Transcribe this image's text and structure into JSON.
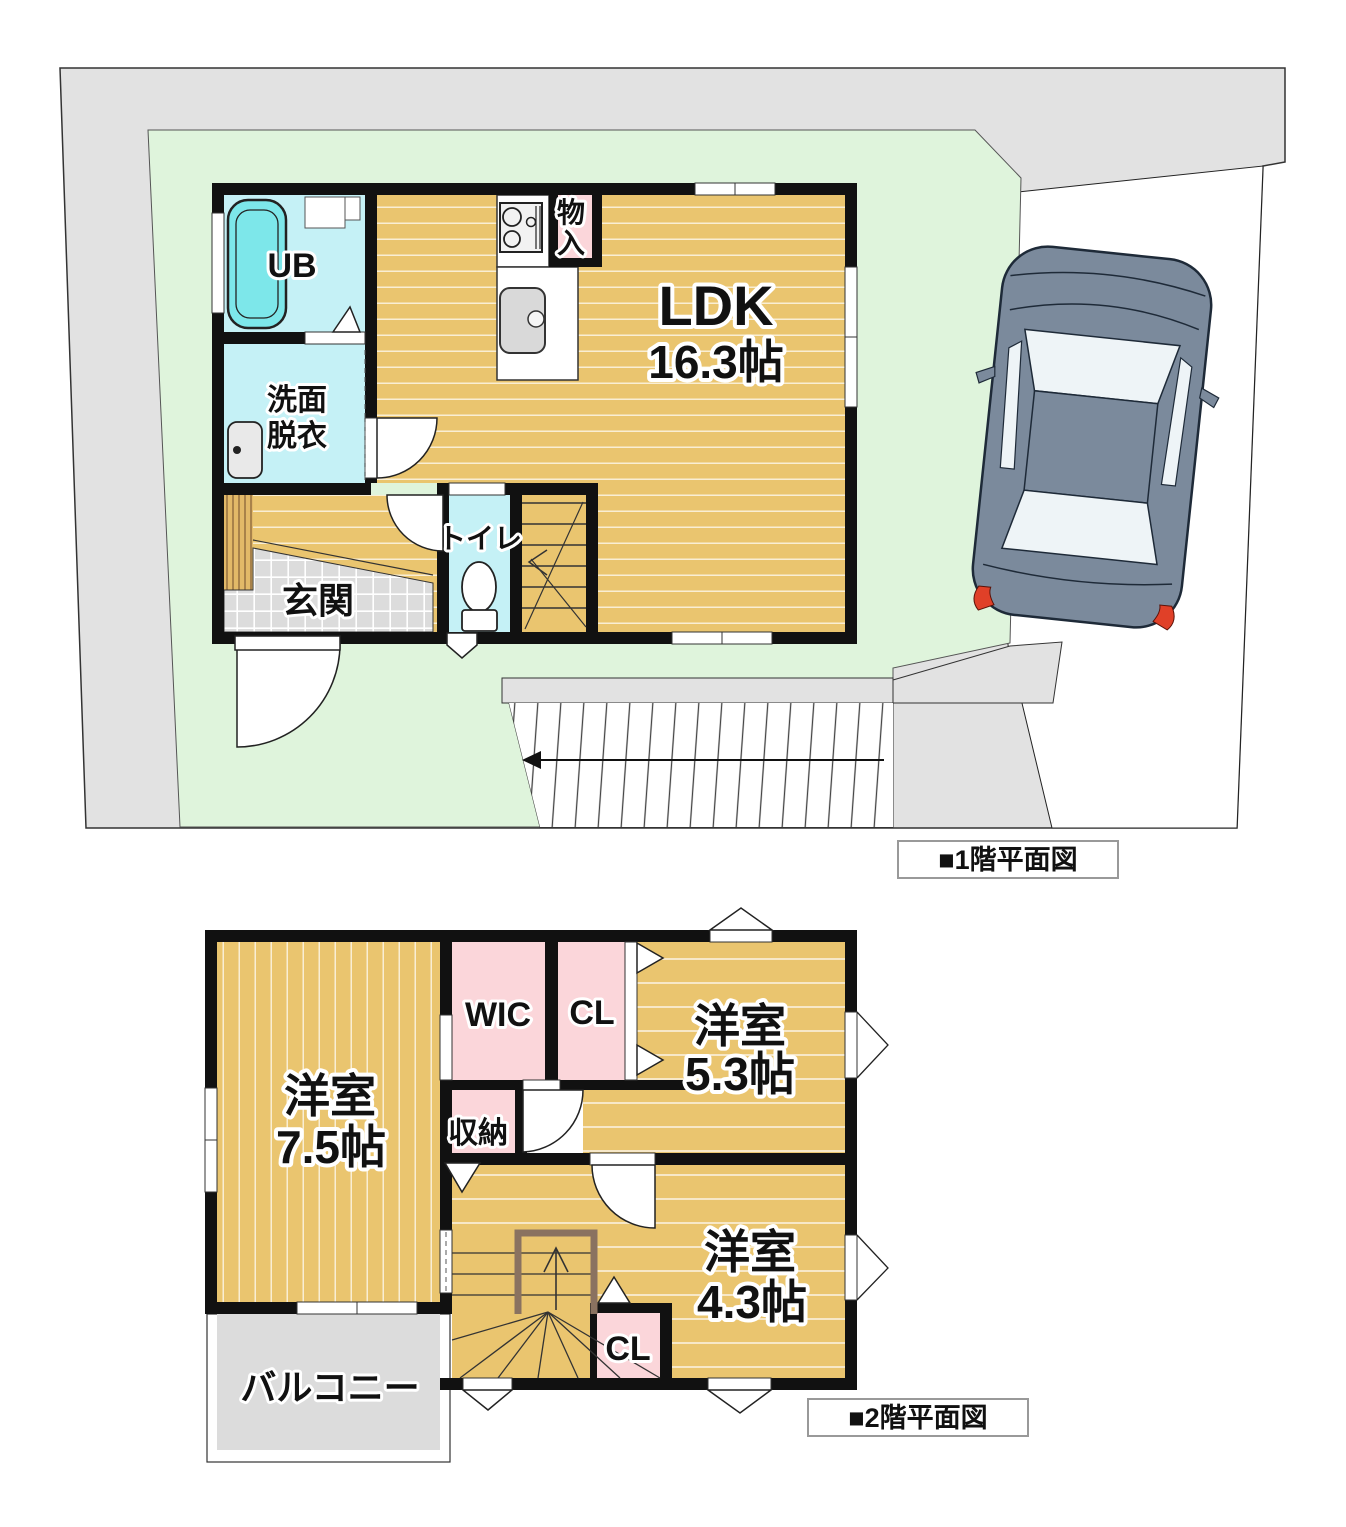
{
  "floor1": {
    "caption": "■1階平面図",
    "ldk_name": "LDK",
    "ldk_size": "16.3帖",
    "ub_label": "UB",
    "wash_line1": "洗面",
    "wash_line2": "脱衣",
    "toilet_label": "トイレ",
    "entrance_label": "玄関",
    "storage_label": "物入"
  },
  "floor2": {
    "caption": "■2階平面図",
    "room75_name": "洋室",
    "room75_size": "7.5帖",
    "room53_name": "洋室",
    "room53_size": "5.3帖",
    "room43_name": "洋室",
    "room43_size": "4.3帖",
    "wic_label": "WIC",
    "cl_upper_label": "CL",
    "cl_lower_label": "CL",
    "storage_label": "収納",
    "balcony_label": "バルコニー"
  },
  "colors": {
    "wall": "#111111",
    "floor_wood": "#eac56f",
    "room_pink": "#fbd6da",
    "room_cyan": "#c5f1f6",
    "bathtub": "#7de7ea",
    "lawn_green": "#dff4dc",
    "road_gray": "#e2e2e2",
    "tile_gray": "#dcdcdc",
    "balcony_gray": "#dcdcdc",
    "stair_rail_brown": "#8a7260",
    "car_body": "#7b8a9c",
    "taillight_red": "#e04028"
  }
}
